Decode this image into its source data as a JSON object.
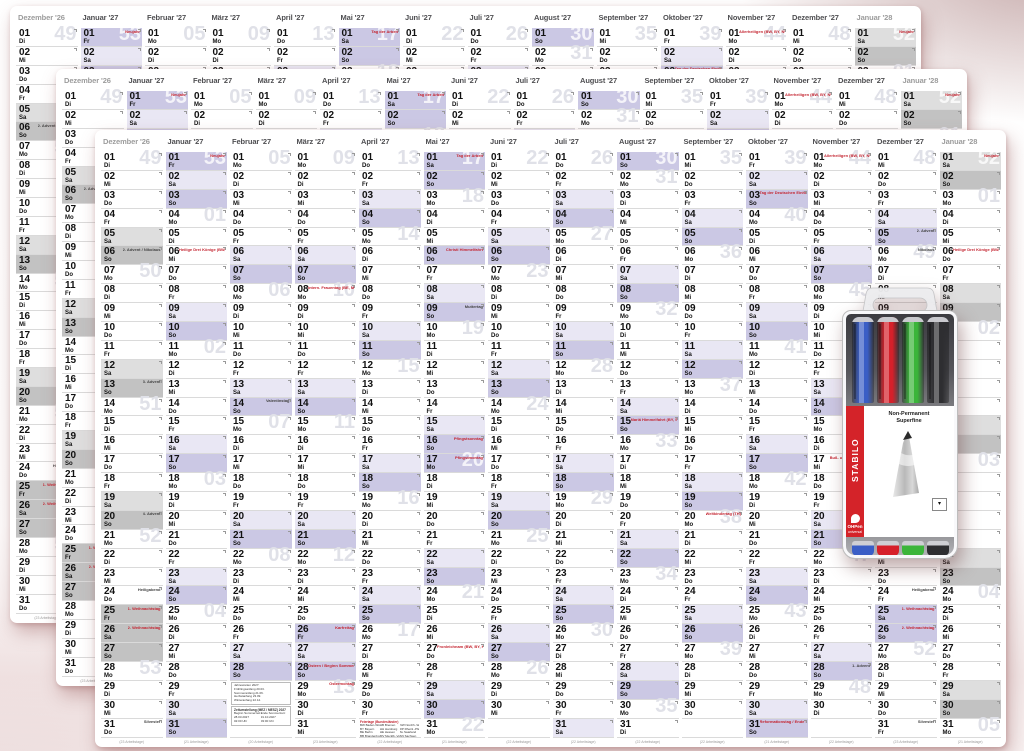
{
  "calendar": {
    "weekdays": [
      "Mo",
      "Di",
      "Mi",
      "Do",
      "Fr",
      "Sa",
      "So"
    ],
    "colors": {
      "saturday": "#e9e7f4",
      "sunday": "#cbc8e4",
      "holiday": "#cbc8e4",
      "muted_saturday": "#dedede",
      "muted_sunday": "#c2c2c2",
      "holiday_red": "#c42430",
      "note_dark": "#444444",
      "watermark": "#e0e1e8",
      "watermark_on_shade": "rgba(255,255,255,0.78)"
    },
    "months": [
      {
        "label": "Dezember '26",
        "y": 2026,
        "m": 12,
        "days": 31,
        "start": 1,
        "muted": true,
        "ft": "(23 Arbeitstage)",
        "notes": [
          {
            "d": 6,
            "t": "2. Advent / Nikolaus"
          },
          {
            "d": 13,
            "t": "3. Advent"
          },
          {
            "d": 20,
            "t": "4. Advent"
          },
          {
            "d": 24,
            "t": "Heiligabend"
          },
          {
            "d": 25,
            "t": "1. Weihnachtstag",
            "r": true,
            "s": true
          },
          {
            "d": 26,
            "t": "2. Weihnachtstag",
            "r": true,
            "s": true
          },
          {
            "d": 31,
            "t": "Silvester"
          }
        ]
      },
      {
        "label": "Januar '27",
        "y": 2027,
        "m": 1,
        "days": 31,
        "start": 4,
        "muted": false,
        "ft": "(21 Arbeitstage)",
        "notes": [
          {
            "d": 1,
            "t": "Neujahr",
            "r": true,
            "s": true
          },
          {
            "d": 6,
            "t": "Heilige Drei Könige (BW, BY, ST)",
            "r": true
          }
        ]
      },
      {
        "label": "Februar '27",
        "y": 2027,
        "m": 2,
        "days": 28,
        "start": 0,
        "muted": false,
        "ft": "(20 Arbeitstage)",
        "legend": "feb",
        "notes": [
          {
            "d": 14,
            "t": "Valentinstag"
          }
        ]
      },
      {
        "label": "März '27",
        "y": 2027,
        "m": 3,
        "days": 31,
        "start": 0,
        "muted": false,
        "ft": "(23 Arbeitstage)",
        "notes": [
          {
            "d": 8,
            "t": "Intern. Frauentag (BE, MV)",
            "r": true
          },
          {
            "d": 26,
            "t": "Karfreitag",
            "r": true,
            "s": true
          },
          {
            "d": 28,
            "t": "Ostern / Beginn Sommerzeit",
            "r": true
          },
          {
            "d": 29,
            "t": "Ostermontag",
            "r": true
          }
        ]
      },
      {
        "label": "April '27",
        "y": 2027,
        "m": 4,
        "days": 30,
        "start": 3,
        "muted": false,
        "ft": "(22 Arbeitstage)",
        "legend": "apr",
        "notes": []
      },
      {
        "label": "Mai '27",
        "y": 2027,
        "m": 5,
        "days": 31,
        "start": 5,
        "muted": false,
        "ft": "(21 Arbeitstage)",
        "notes": [
          {
            "d": 1,
            "t": "Tag der Arbeit",
            "r": true,
            "s": true
          },
          {
            "d": 6,
            "t": "Christi Himmelfahrt",
            "r": true,
            "s": true
          },
          {
            "d": 9,
            "t": "Muttertag"
          },
          {
            "d": 16,
            "t": "Pfingstsonntag",
            "r": true
          },
          {
            "d": 17,
            "t": "Pfingstmontag",
            "r": true,
            "s": true
          },
          {
            "d": 27,
            "t": "Fronleichnam (BW, BY, HE, NW, RP, SL)",
            "r": true
          }
        ]
      },
      {
        "label": "Juni '27",
        "y": 2027,
        "m": 6,
        "days": 30,
        "start": 1,
        "muted": false,
        "ft": "(22 Arbeitstage)",
        "notes": []
      },
      {
        "label": "Juli '27",
        "y": 2027,
        "m": 7,
        "days": 31,
        "start": 3,
        "muted": false,
        "ft": "(22 Arbeitstage)",
        "notes": []
      },
      {
        "label": "August '27",
        "y": 2027,
        "m": 8,
        "days": 31,
        "start": 6,
        "muted": false,
        "ft": "(22 Arbeitstage)",
        "notes": [
          {
            "d": 15,
            "t": "Mariä Himmelfahrt (BY, SL)",
            "r": true
          }
        ]
      },
      {
        "label": "September '27",
        "y": 2027,
        "m": 9,
        "days": 30,
        "start": 2,
        "muted": false,
        "ft": "(22 Arbeitstage)",
        "notes": [
          {
            "d": 20,
            "t": "Weltkindertag (TH)",
            "r": true
          }
        ]
      },
      {
        "label": "Oktober '27",
        "y": 2027,
        "m": 10,
        "days": 31,
        "start": 4,
        "muted": false,
        "ft": "(21 Arbeitstage)",
        "notes": [
          {
            "d": 3,
            "t": "Tag der Deutschen Einheit",
            "r": true
          },
          {
            "d": 31,
            "t": "Reformationstag / Ende Sommerzeit",
            "r": true
          }
        ]
      },
      {
        "label": "November '27",
        "y": 2027,
        "m": 11,
        "days": 30,
        "start": 0,
        "muted": false,
        "ft": "(22 Arbeitstage)",
        "notes": [
          {
            "d": 1,
            "t": "Allerheiligen (BW, BY, NW, RP, SL)",
            "r": true
          },
          {
            "d": 17,
            "t": "Buß- und Bettag (SN)",
            "r": true
          },
          {
            "d": 28,
            "t": "1. Advent"
          }
        ]
      },
      {
        "label": "Dezember '27",
        "y": 2027,
        "m": 12,
        "days": 31,
        "start": 2,
        "muted": false,
        "ft": "(23 Arbeitstage)",
        "notes": [
          {
            "d": 5,
            "t": "2. Advent"
          },
          {
            "d": 6,
            "t": "Nikolaus"
          },
          {
            "d": 12,
            "t": "3. Advent"
          },
          {
            "d": 19,
            "t": "4. Advent"
          },
          {
            "d": 24,
            "t": "Heiligabend"
          },
          {
            "d": 25,
            "t": "1. Weihnachtstag",
            "r": true,
            "s": true
          },
          {
            "d": 26,
            "t": "2. Weihnachtstag",
            "r": true,
            "s": true
          },
          {
            "d": 31,
            "t": "Silvester"
          }
        ]
      },
      {
        "label": "Januar '28",
        "y": 2028,
        "m": 1,
        "days": 31,
        "start": 5,
        "muted": true,
        "ft": "(21 Arbeitstage)",
        "notes": [
          {
            "d": 1,
            "t": "Neujahr",
            "r": true
          },
          {
            "d": 6,
            "t": "Heilige Drei Könige (BW, BY, ST)",
            "r": true
          }
        ]
      }
    ],
    "legend_feb": {
      "box1_lines": [
        "Jahreszeiten 2027:",
        "Frühlingsanfang 20.03.",
        "Sommeranfang 21.06.",
        "Herbstanfang 23.09.",
        "Winteranfang 22.12."
      ],
      "box2_title": "Zeitumstellung (MEZ / MESZ) 2027",
      "box2_left": [
        "Beginn Sommerzeit:",
        "28.03.2027",
        "02:00 Uhr"
      ],
      "box2_right": [
        "Ende Sommerzeit:",
        "31.10.2027",
        "03:00 Uhr"
      ]
    },
    "legend_apr": {
      "title": "Feiertage (Bundesländer)",
      "cols": [
        [
          "BW Baden-Württ.",
          "BY Bayern",
          "BE Berlin",
          "BB Brandenbg."
        ],
        [
          "HB Bremen",
          "HH Hamburg",
          "HE Hessen",
          "MV Mecklb.-Vorp."
        ],
        [
          "NW Nordrh.-Westf.",
          "RP Rheinl.-Pfalz",
          "SL Saarland",
          "SN Sachsen"
        ]
      ]
    }
  },
  "pen_pack": {
    "brand": "STABILO",
    "line1": "Non-Permanent",
    "line2": "Superfine",
    "product": "OHPen",
    "product_sub": "universal",
    "pen_colors": [
      "#3a5ec6",
      "#d6202a",
      "#3bb53a",
      "#2e2e31"
    ],
    "nib_box_glyph": "▾"
  }
}
